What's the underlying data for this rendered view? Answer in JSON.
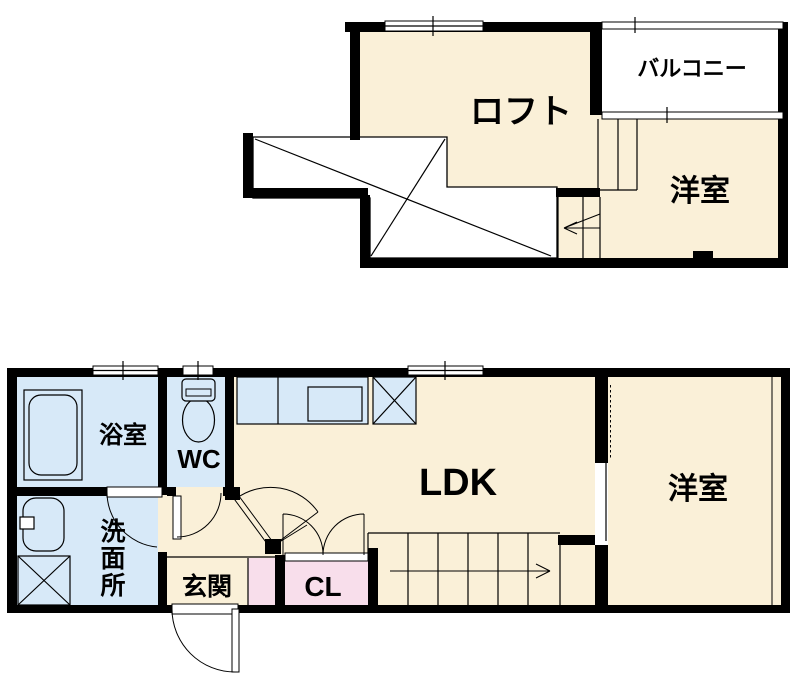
{
  "colors": {
    "room": "#FAF0D8",
    "wet_area": "#D7E9F8",
    "closet": "#F8DEEB",
    "wall": "#000000",
    "background": "#FFFFFF"
  },
  "upper_floor": {
    "loft_label": "ロフト",
    "balcony_label": "バルコニー",
    "bedroom_label": "洋室"
  },
  "lower_floor": {
    "bathroom_label": "浴室",
    "toilet_label": "WC",
    "washroom_label": [
      "洗",
      "面",
      "所"
    ],
    "entrance_label": "玄関",
    "closet_label": "CL",
    "ldk_label": "LDK",
    "bedroom_label": "洋室"
  }
}
